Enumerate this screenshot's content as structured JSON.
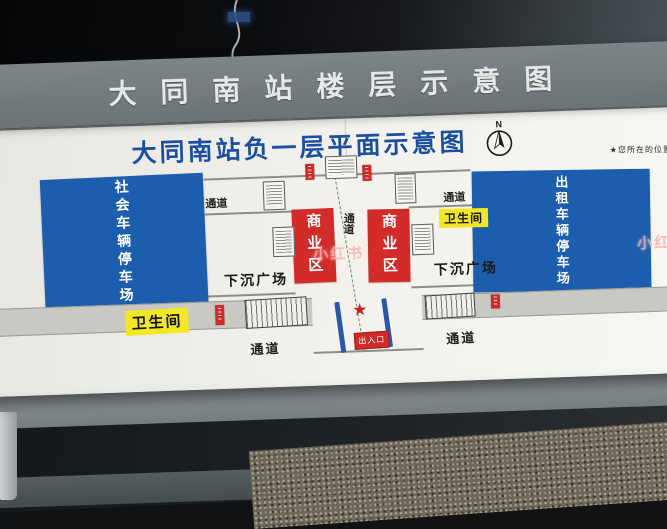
{
  "scene": {
    "watermark": "小红书"
  },
  "board": {
    "title": "大同南站楼层示意图"
  },
  "map": {
    "title": "大同南站负一层平面示意图",
    "compass": "N",
    "you_are_here_note": "★您所在的位置",
    "star": "★",
    "labels": {
      "left_parking": "社会车辆停车场",
      "right_parking": "出租车辆停车场",
      "commercial_left": "商业区",
      "commercial_right": "商业区",
      "sunken_plaza_left": "下沉广场",
      "sunken_plaza_right": "下沉广场",
      "toilet_left": "卫生间",
      "toilet_right": "卫生间",
      "passage_top_left": "通道",
      "passage_top_right": "通道",
      "passage_center": "通道",
      "passage_bottom_left": "通道",
      "passage_bottom_right": "通道",
      "exit_center": "出入口"
    },
    "colors": {
      "parking_blue": "#1d5dad",
      "commercial_red": "#d32b28",
      "toilet_yellow": "#f2e724",
      "title_blue": "#1d4fa0",
      "corridor_gray": "#c9c8c2"
    }
  }
}
